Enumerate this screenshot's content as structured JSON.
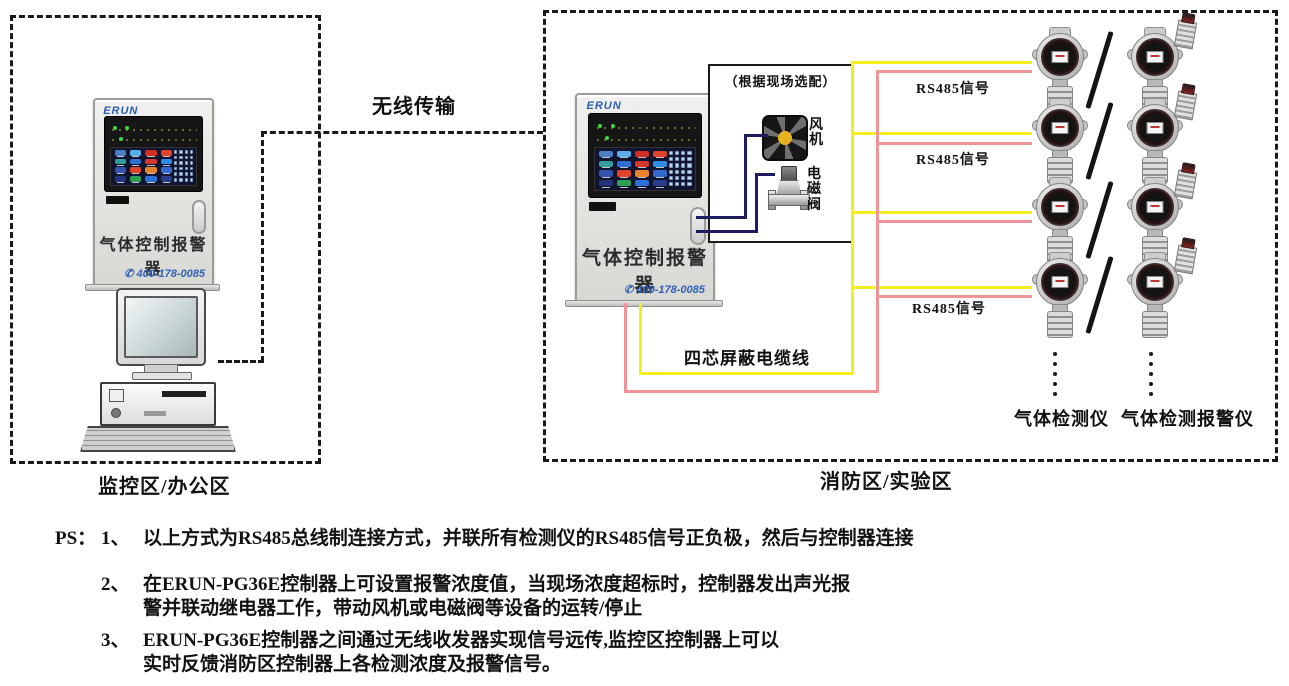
{
  "zones": {
    "monitor": {
      "label": "监控区/办公区"
    },
    "fire": {
      "label": "消防区/实验区"
    }
  },
  "wireless": {
    "label": "无线传输"
  },
  "controller": {
    "brand": "ERUN",
    "name": "气体控制报警器",
    "phone_icon": "✆",
    "phone": "400-178-0085"
  },
  "option_box": {
    "title": "（根据现场选配）",
    "fan_label": "风机",
    "valve_label": "电磁阀"
  },
  "cable": {
    "label": "四芯屏蔽电缆线",
    "rs485_label": "RS485信号"
  },
  "detectors": {
    "rows": 4,
    "left_label": "气体检测仪",
    "right_label": "气体检测报警仪"
  },
  "notes": {
    "prefix": "PS：",
    "items": [
      {
        "num": "1、",
        "lines": [
          "以上方式为RS485总线制连接方式，并联所有检测仪的RS485信号正负极，然后与控制器连接"
        ]
      },
      {
        "num": "2、",
        "lines": [
          "在ERUN-PG36E控制器上可设置报警浓度值，当现场浓度超标时，控制器发出声光报",
          "警并联动继电器工作，带动风机或电磁阀等设备的运转/停止"
        ]
      },
      {
        "num": "3、",
        "lines": [
          "ERUN-PG36E控制器之间通过无线收发器实现信号远传,监控区控制器上可以",
          "实时反馈消防区控制器上各检测浓度及报警信号。"
        ]
      }
    ]
  },
  "colors": {
    "cable_yellow": "#f3ee1f",
    "cable_pink": "#ee9398",
    "wire_navy": "#1c1c5e",
    "phone_blue": "#2f62b8",
    "logo_blue": "#2a5db0"
  },
  "screen": {
    "tile_colors": [
      "#4a7fc4",
      "#58aee8",
      "#cf2e22",
      "#e0452a",
      "#2f9e9a",
      "#2f6fd4",
      "#d4372e",
      "#2f8de4",
      "#3552b0",
      "#e04328",
      "#e8822a",
      "#3568cc",
      "#24357e",
      "#2e9e55",
      "#2f6fd8",
      "#283c8c"
    ],
    "key_color": "#bcd6ee"
  }
}
